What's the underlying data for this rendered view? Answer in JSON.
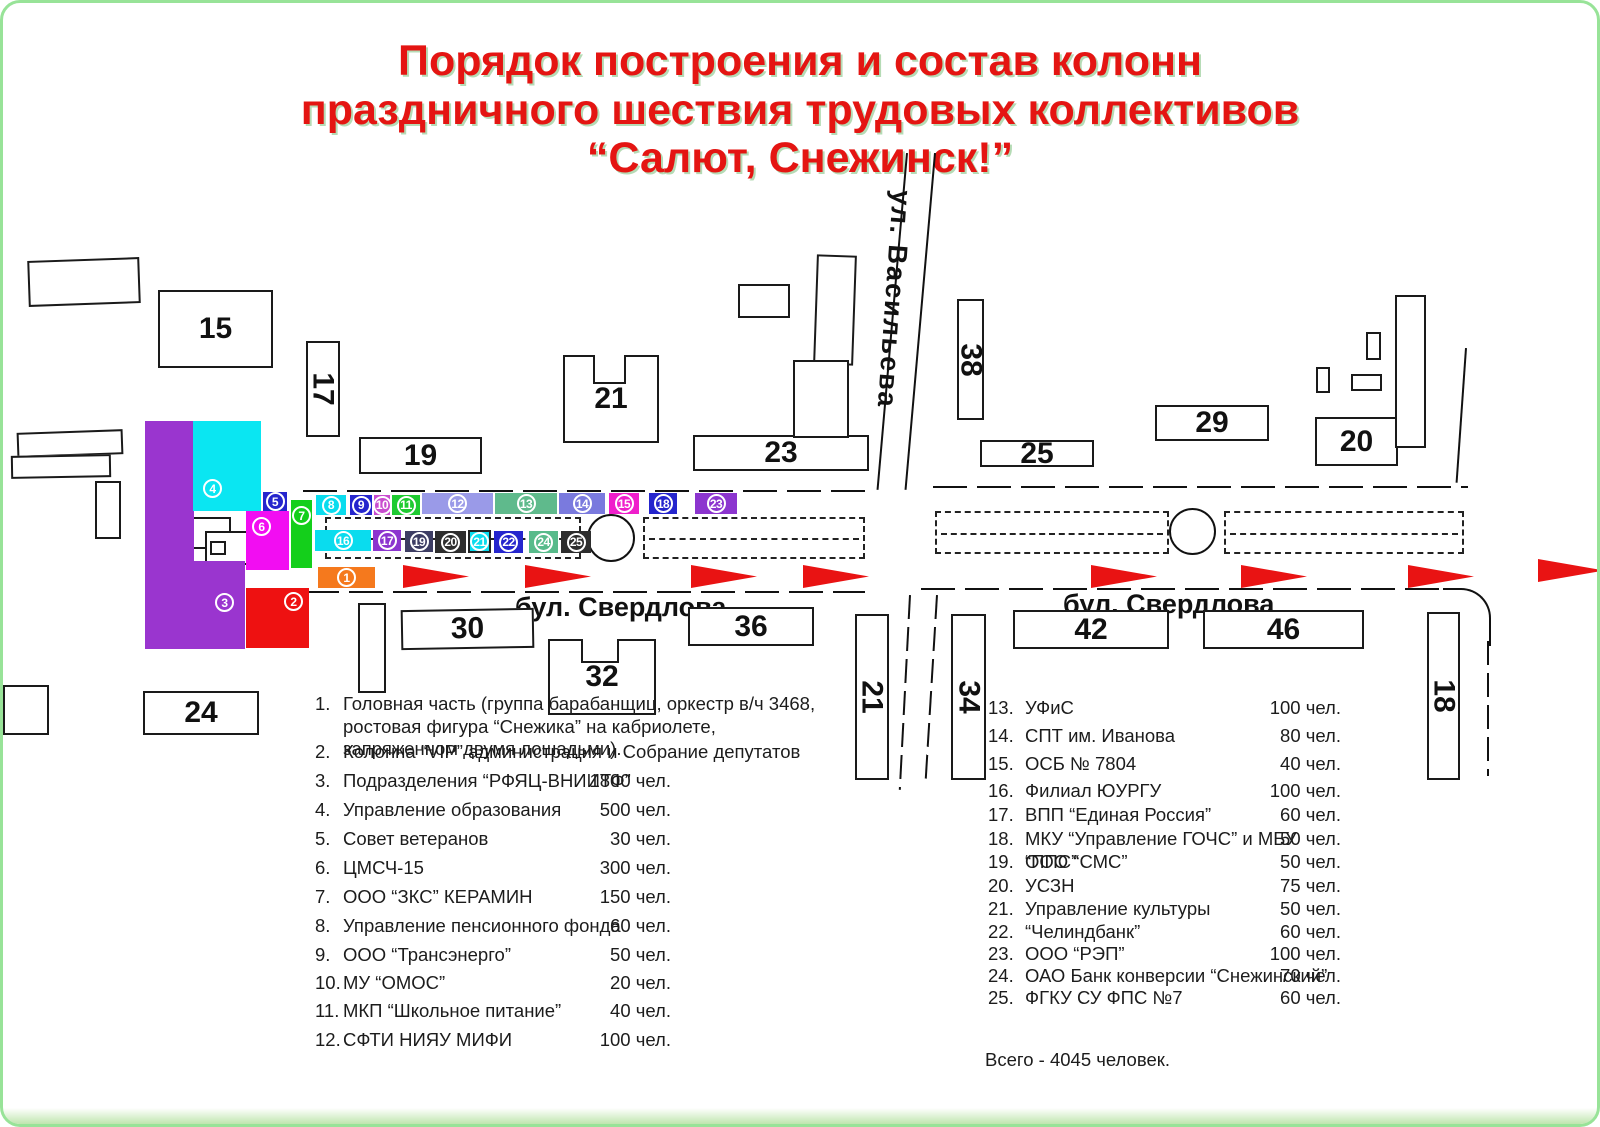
{
  "title": {
    "line1": "Порядок построения и состав колонн",
    "line2": "праздничного шествия трудовых коллективов",
    "line3": "“Салют, Снежинск!”"
  },
  "streets": {
    "vasilyeva": "ул. Васильева",
    "sverdlova_left": "бул. Свердлова",
    "sverdlova_right": "бул. Свердлова"
  },
  "map": {
    "arrow_color": "#e91313",
    "arrows": [
      {
        "x": 400,
        "y": 562
      },
      {
        "x": 522,
        "y": 562
      },
      {
        "x": 688,
        "y": 562
      },
      {
        "x": 800,
        "y": 562
      },
      {
        "x": 1088,
        "y": 562
      },
      {
        "x": 1238,
        "y": 562
      },
      {
        "x": 1405,
        "y": 562
      },
      {
        "x": 1535,
        "y": 556
      }
    ],
    "buildings": [
      {
        "label": "",
        "x": 25,
        "y": 256,
        "w": 112,
        "h": 46,
        "rot": -2
      },
      {
        "label": "15",
        "x": 155,
        "y": 287,
        "w": 115,
        "h": 78
      },
      {
        "label": "17",
        "x": 303,
        "y": 338,
        "w": 34,
        "h": 96,
        "vert": true
      },
      {
        "label": "19",
        "x": 356,
        "y": 434,
        "w": 123,
        "h": 37
      },
      {
        "label": "21",
        "x": 560,
        "y": 352,
        "w": 96,
        "h": 88,
        "notch": true
      },
      {
        "label": "23",
        "x": 690,
        "y": 432,
        "w": 176,
        "h": 36
      },
      {
        "label": "",
        "x": 735,
        "y": 281,
        "w": 52,
        "h": 34
      },
      {
        "label": "",
        "x": 812,
        "y": 252,
        "w": 40,
        "h": 110,
        "rot": 2
      },
      {
        "label": "",
        "x": 790,
        "y": 357,
        "w": 56,
        "h": 78
      },
      {
        "label": "38",
        "x": 954,
        "y": 296,
        "w": 27,
        "h": 121,
        "vert": true
      },
      {
        "label": "25",
        "x": 977,
        "y": 437,
        "w": 114,
        "h": 27
      },
      {
        "label": "29",
        "x": 1152,
        "y": 402,
        "w": 114,
        "h": 36
      },
      {
        "label": "20",
        "x": 1312,
        "y": 414,
        "w": 83,
        "h": 49
      },
      {
        "label": "",
        "x": 1392,
        "y": 292,
        "w": 31,
        "h": 153
      },
      {
        "label": "",
        "x": 1363,
        "y": 329,
        "w": 15,
        "h": 28
      },
      {
        "label": "",
        "x": 1313,
        "y": 364,
        "w": 14,
        "h": 26
      },
      {
        "label": "",
        "x": 1348,
        "y": 371,
        "w": 31,
        "h": 17
      },
      {
        "label": "",
        "x": 355,
        "y": 600,
        "w": 28,
        "h": 90
      },
      {
        "label": "30",
        "x": 398,
        "y": 606,
        "w": 133,
        "h": 40,
        "rot": -1
      },
      {
        "label": "32",
        "x": 545,
        "y": 636,
        "w": 108,
        "h": 76,
        "notch": true
      },
      {
        "label": "36",
        "x": 685,
        "y": 604,
        "w": 126,
        "h": 39
      },
      {
        "label": "24",
        "x": 140,
        "y": 688,
        "w": 116,
        "h": 44
      },
      {
        "label": "",
        "x": 0,
        "y": 682,
        "w": 46,
        "h": 50
      },
      {
        "label": "21",
        "x": 852,
        "y": 611,
        "w": 34,
        "h": 166,
        "vert": true
      },
      {
        "label": "34",
        "x": 948,
        "y": 611,
        "w": 35,
        "h": 166,
        "vert": true
      },
      {
        "label": "42",
        "x": 1010,
        "y": 607,
        "w": 156,
        "h": 39
      },
      {
        "label": "46",
        "x": 1200,
        "y": 607,
        "w": 161,
        "h": 39
      },
      {
        "label": "18",
        "x": 1424,
        "y": 609,
        "w": 33,
        "h": 168,
        "vert": true
      },
      {
        "label": "",
        "x": 14,
        "y": 428,
        "w": 106,
        "h": 25,
        "rot": -2
      },
      {
        "label": "",
        "x": 8,
        "y": 452,
        "w": 100,
        "h": 23,
        "rot": -1
      },
      {
        "label": "",
        "x": 92,
        "y": 478,
        "w": 26,
        "h": 58
      },
      {
        "label": "",
        "x": 186,
        "y": 514,
        "w": 42,
        "h": 32
      },
      {
        "label": "",
        "x": 202,
        "y": 528,
        "w": 45,
        "h": 34
      },
      {
        "label": "",
        "x": 207,
        "y": 538,
        "w": 16,
        "h": 14
      }
    ],
    "columns": [
      {
        "n": 3,
        "c": "#9a35cf",
        "x": 142,
        "y": 418,
        "w": 49,
        "h": 228,
        "nolabel": true
      },
      {
        "n": 3,
        "c": "#9a35cf",
        "x": 190,
        "y": 558,
        "w": 52,
        "h": 88,
        "lp": {
          "l": 22,
          "t": 32
        }
      },
      {
        "n": 4,
        "c": "#0ae6f2",
        "x": 190,
        "y": 418,
        "w": 68,
        "h": 90,
        "lp": {
          "l": 10,
          "t": 58
        }
      },
      {
        "n": 5,
        "c": "#2525cd",
        "x": 260,
        "y": 489,
        "w": 24,
        "h": 19
      },
      {
        "n": 6,
        "c": "#f20df2",
        "x": 243,
        "y": 508,
        "w": 43,
        "h": 59,
        "lp": {
          "l": 6,
          "t": 6
        }
      },
      {
        "n": 7,
        "c": "#14cf1b",
        "x": 288,
        "y": 497,
        "w": 21,
        "h": 68,
        "lp": {
          "l": 1,
          "t": 6
        }
      },
      {
        "n": 2,
        "c": "#ee1111",
        "x": 243,
        "y": 585,
        "w": 63,
        "h": 60,
        "lp": {
          "l": 38,
          "t": 4
        }
      },
      {
        "n": 1,
        "c": "#f5791d",
        "x": 315,
        "y": 564,
        "w": 57,
        "h": 21
      },
      {
        "n": 8,
        "c": "#0adcee",
        "x": 313,
        "y": 492,
        "w": 30,
        "h": 20
      },
      {
        "n": 9,
        "c": "#2525cd",
        "x": 347,
        "y": 492,
        "w": 22,
        "h": 20
      },
      {
        "n": 10,
        "c": "#c94ccf",
        "x": 371,
        "y": 492,
        "w": 16,
        "h": 20
      },
      {
        "n": 11,
        "c": "#1ecb31",
        "x": 389,
        "y": 492,
        "w": 28,
        "h": 20
      },
      {
        "n": 12,
        "c": "#9a9ae8",
        "x": 419,
        "y": 490,
        "w": 71,
        "h": 21
      },
      {
        "n": 13,
        "c": "#5fba8c",
        "x": 492,
        "y": 490,
        "w": 62,
        "h": 21
      },
      {
        "n": 14,
        "c": "#7a7ade",
        "x": 556,
        "y": 490,
        "w": 46,
        "h": 21
      },
      {
        "n": 15,
        "c": "#ef1ecb",
        "x": 606,
        "y": 490,
        "w": 30,
        "h": 21
      },
      {
        "n": 18,
        "c": "#2525cd",
        "x": 646,
        "y": 490,
        "w": 28,
        "h": 21
      },
      {
        "n": 23,
        "c": "#8c35cf",
        "x": 692,
        "y": 490,
        "w": 42,
        "h": 21
      },
      {
        "n": 16,
        "c": "#0adcee",
        "x": 312,
        "y": 527,
        "w": 56,
        "h": 21
      },
      {
        "n": 17,
        "c": "#8c35cf",
        "x": 370,
        "y": 527,
        "w": 28,
        "h": 21
      },
      {
        "n": 19,
        "c": "#3d3d63",
        "x": 402,
        "y": 528,
        "w": 28,
        "h": 21
      },
      {
        "n": 20,
        "c": "#2d2d2d",
        "x": 432,
        "y": 528,
        "w": 31,
        "h": 22
      },
      {
        "n": 21,
        "c": "#0adcee",
        "x": 465,
        "y": 527,
        "w": 23,
        "h": 23,
        "border": "#222"
      },
      {
        "n": 22,
        "c": "#2525cd",
        "x": 491,
        "y": 528,
        "w": 29,
        "h": 22
      },
      {
        "n": 24,
        "c": "#58bb8b",
        "x": 526,
        "y": 528,
        "w": 29,
        "h": 22
      },
      {
        "n": 25,
        "c": "#2d2d2d",
        "x": 558,
        "y": 528,
        "w": 30,
        "h": 22
      }
    ]
  },
  "legend": {
    "left": [
      {
        "num": "1.",
        "name": "Головная часть (группа барабанщиц, оркестр в/ч 3468, ростовая фигура “Снежика” на кабриолете, запряженном двумя лошадьми).",
        "count": ""
      },
      {
        "num": "2.",
        "name": "Колонна “VIP” администрация и Собрание депутатов",
        "count": ""
      },
      {
        "num": "3.",
        "name": "Подразделения “РФЯЦ-ВНИИТФ”",
        "count": "1800 чел."
      },
      {
        "num": "4.",
        "name": "Управление образования",
        "count": "500 чел."
      },
      {
        "num": "5.",
        "name": "Совет ветеранов",
        "count": "30 чел."
      },
      {
        "num": "6.",
        "name": "ЦМСЧ-15",
        "count": "300 чел."
      },
      {
        "num": "7.",
        "name": "ООО “ЗКС” КЕРАМИН",
        "count": "150 чел."
      },
      {
        "num": "8.",
        "name": "Управление пенсионного фонда",
        "count": "60 чел."
      },
      {
        "num": "9.",
        "name": "ООО “Трансэнерго”",
        "count": "50 чел."
      },
      {
        "num": "10.",
        "name": "МУ  “ОМОС”",
        "count": "20 чел."
      },
      {
        "num": "11.",
        "name": "МКП  “Школьное питание”",
        "count": "40 чел."
      },
      {
        "num": "12.",
        "name": "СФТИ НИЯУ МИФИ",
        "count": "100 чел."
      }
    ],
    "right": [
      {
        "num": "13.",
        "name": "УФиС",
        "count": "100 чел."
      },
      {
        "num": "14.",
        "name": "СПТ им. Иванова",
        "count": "80 чел."
      },
      {
        "num": "15.",
        "name": "ОСБ № 7804",
        "count": "40 чел."
      },
      {
        "num": "16.",
        "name": "Филиал ЮУРГУ",
        "count": "100 чел."
      },
      {
        "num": "17.",
        "name": "ВПП “Единая Россия”",
        "count": "60 чел."
      },
      {
        "num": "18.",
        "name": "МКУ “Управление ГОЧС” и МБУ “ППС”",
        "count": "50 чел."
      },
      {
        "num": "19.",
        "name": "ООО “СМС”",
        "count": "50 чел."
      },
      {
        "num": "20.",
        "name": "УСЗН",
        "count": "75 чел."
      },
      {
        "num": "21.",
        "name": "Управление культуры",
        "count": "50 чел."
      },
      {
        "num": "22.",
        "name": "“Челиндбанк”",
        "count": "60 чел."
      },
      {
        "num": "23.",
        "name": "ООО “РЭП”",
        "count": "100 чел."
      },
      {
        "num": "24.",
        "name": "ОАО Банк конверсии “Снежинский”",
        "count": "70 чел."
      },
      {
        "num": "25.",
        "name": "ФГКУ СУ ФПС №7",
        "count": "60 чел."
      }
    ],
    "total": "Всего - 4045 человек."
  }
}
